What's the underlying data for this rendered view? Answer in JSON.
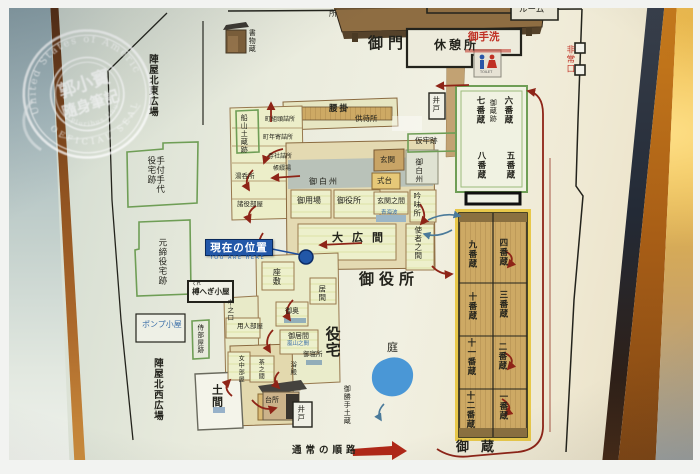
{
  "stamp": {
    "arc_top": "United States of America",
    "center_line1": "郭小寶",
    "center_line2": "隨身筆記",
    "arc_middle": "E Pluribus Unum",
    "arc_bottom": "OFFICIAL SEAL"
  },
  "map": {
    "title_labels": {
      "gomon": "御門",
      "kyukeisho": "休憩所",
      "oyakusho_big": "御役所",
      "yakutaku": "役宅",
      "niwa": "庭",
      "okura": "御蔵"
    },
    "plazas": {
      "ne": "陣屋北東広場",
      "nw": "陣屋北西広場"
    },
    "sites": {
      "tetsuke": "手付手代役宅跡",
      "motojime": "元締役宅跡",
      "samurai": "侍部屋跡",
      "funayama": "船山土蔵跡",
      "kariro": "仮牢跡",
      "kurehegi": "榑へぎ小屋",
      "kurehegi_kana": "くれ",
      "pompu": "ポンプ小屋",
      "shomotsugura": "書物蔵"
    },
    "rooms": {
      "koshikake": "腰掛",
      "tomomachijo": "供待所",
      "machigumigashira": "町組頭詰所",
      "machidoshiyori": "町年寄詰所",
      "jisha": "寺社詰所",
      "chotoji": "帳綴場",
      "yunomijo": "湯呑所",
      "shoyakubeya": "諸役部屋",
      "genkan": "玄関",
      "shikidai": "式台",
      "oshirasu_a": "御白州",
      "oshirasu_b": "御白州",
      "goyoba": "御用場",
      "oyakusho": "御役所",
      "genkannoma": "玄関之間",
      "seigaiha": "青海波",
      "ginmisho": "吟味所",
      "ohiroma": "大広間",
      "shishanoma": "使者之間",
      "zashiki": "座敷",
      "ima": "居間",
      "nakanokuchi": "中之口",
      "ooku": "御奥",
      "goima": "御居間",
      "arashiyama": "嵐山之間",
      "goshinjo": "御寝所",
      "yokuden": "浴殿",
      "yoninbeya": "用人部屋",
      "jochubeya": "女中部屋",
      "chanoma": "茶之間",
      "daidokoro": "台所",
      "doma": "土間",
      "okattedozo": "御勝手土蔵"
    },
    "facilities": {
      "otearai": "御手洗",
      "toilet_sign": "TOILET",
      "hijoguchi": "非常口",
      "ido_east": "井戸",
      "ido_south": "井戸",
      "kanri": "蔵番長屋（管理棟）",
      "ruimu": "ルーム",
      "tokoro_partial": "所"
    },
    "marker": {
      "label": "現在の位置",
      "sub": "YOU ARE HERE"
    },
    "route": {
      "normal": "通常の順路"
    },
    "storehouse": {
      "west_column": [
        "九番蔵",
        "十番蔵",
        "十一番蔵",
        "十二番蔵"
      ],
      "east_column": [
        "四番蔵",
        "三番蔵",
        "二番蔵",
        "一番蔵"
      ]
    },
    "kura_ato": {
      "title": "御蔵跡",
      "row1_east": "六番蔵",
      "row1_west": "七番蔵",
      "row2_east": "五番蔵",
      "row2_west": "八番蔵"
    },
    "colors": {
      "route_red": "#8e2417",
      "route_blue": "#4a7a9a",
      "marker_blue": "#2257a8",
      "site_green": "#6f9e56",
      "pond_blue": "#4a97d6",
      "toilet_red": "#c03024"
    }
  }
}
